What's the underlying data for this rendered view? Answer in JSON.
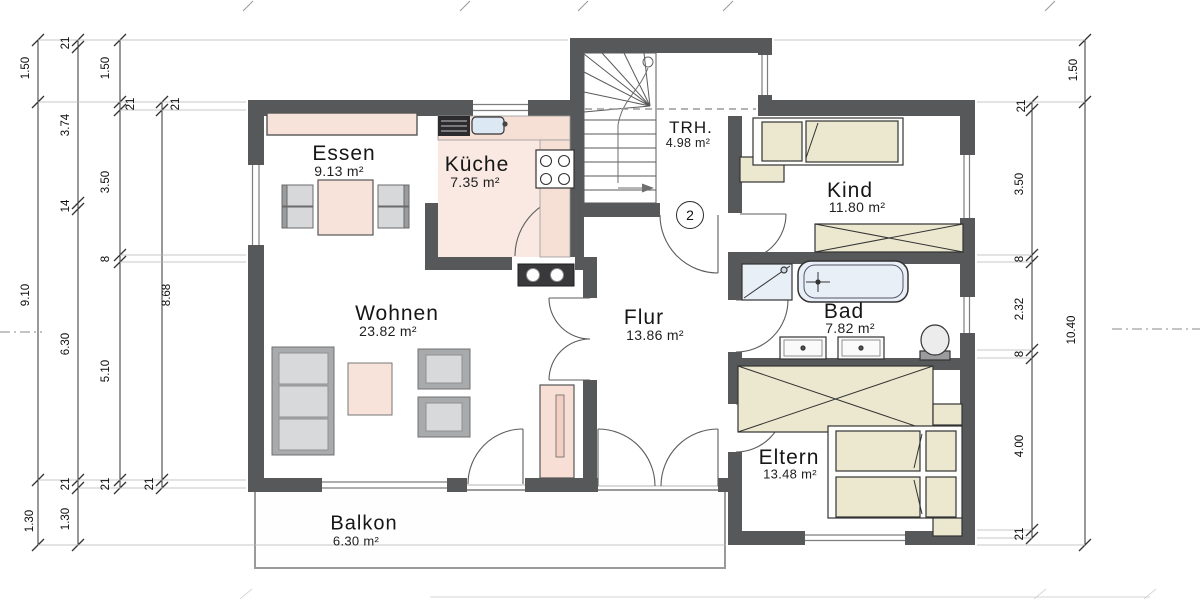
{
  "rooms": [
    {
      "name": "Essen",
      "area": "9.13 m²"
    },
    {
      "name": "Küche",
      "area": "7.35 m²"
    },
    {
      "name": "TRH.",
      "area": "4.98 m²"
    },
    {
      "name": "Kind",
      "area": "11.80 m²"
    },
    {
      "name": "Wohnen",
      "area": "23.82 m²"
    },
    {
      "name": "Flur",
      "area": "13.86 m²"
    },
    {
      "name": "Bad",
      "area": "7.82 m²"
    },
    {
      "name": "Eltern",
      "area": "13.48 m²"
    },
    {
      "name": "Balkon",
      "area": "6.30 m²"
    }
  ],
  "stairwell": {
    "floor_number": "2"
  },
  "dimensions": {
    "left_a": [
      "1.50",
      "9.10",
      "1.30"
    ],
    "left_b": [
      "21",
      "3.74",
      "14",
      "6.30",
      "21",
      "1.30"
    ],
    "left_c": [
      "1.50",
      "21",
      "3.50",
      "8",
      "5.10",
      "21"
    ],
    "left_d": [
      "21",
      "8.68",
      "21"
    ],
    "right_a": [
      "21",
      "3.50",
      "8",
      "2.32",
      "8",
      "4.00",
      "21"
    ],
    "right_b": [
      "1.50",
      "10.40"
    ]
  },
  "colors": {
    "wall": "#57585a",
    "furniture_pink": "#f8e3da",
    "furniture_beige": "#ece8d0",
    "furniture_gray": "#a9aaac",
    "fixture_blue": "#e9eff7",
    "kitchen_floor": "#f9e9e2"
  }
}
